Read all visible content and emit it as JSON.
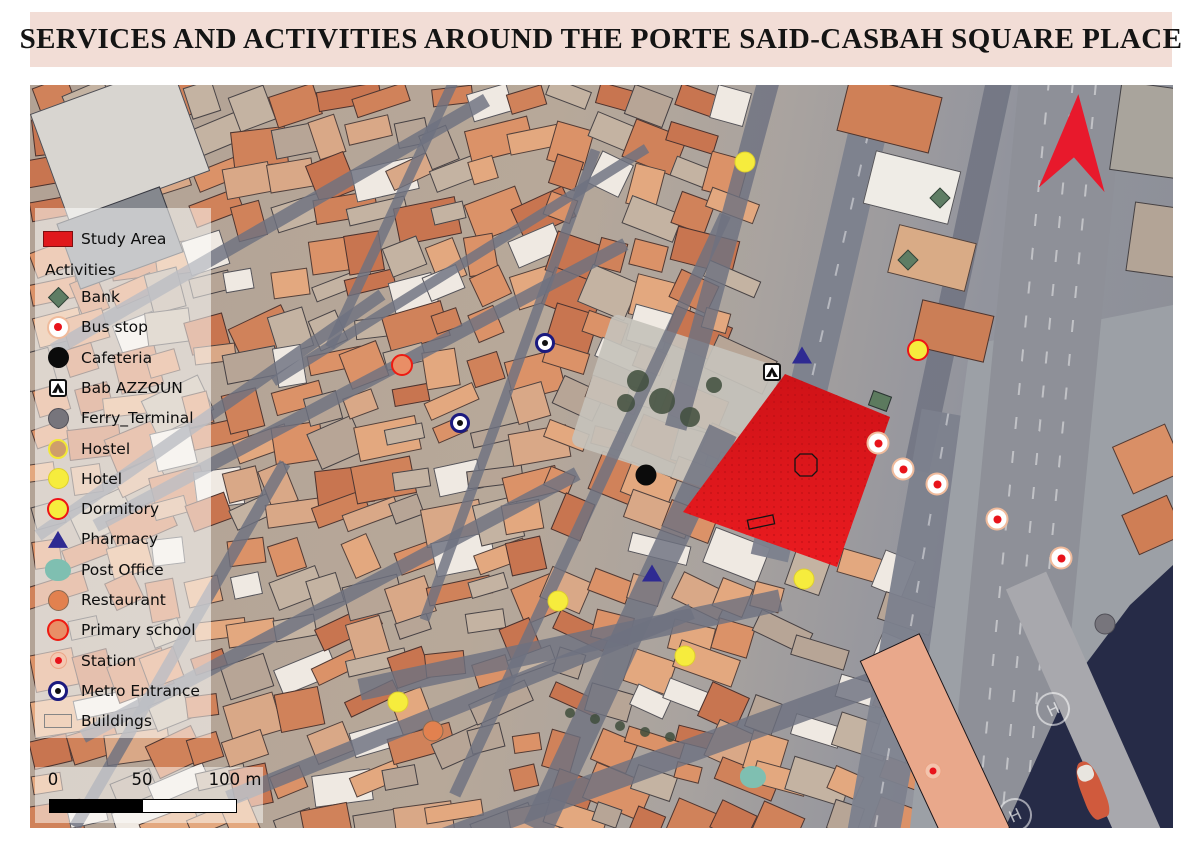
{
  "title": "SERVICES AND ACTIVITIES AROUND THE PORTE SAID-CASBAH SQUARE PLACE",
  "colors": {
    "banner_bg": "#f2ddd6",
    "study_area_red": "#e0181c",
    "bank_green": "#5e7d64",
    "hotel_yellow": "#f6ec3d",
    "dormitory_ring_red": "#ee1316",
    "pharmacy_navy": "#2e2a92",
    "post_office_teal": "#7fbfb1",
    "restaurant_orange": "#e2814f",
    "primary_school_salmon": "#e98e66",
    "metro_ring_navy": "#1b1a7f",
    "bus_stop_ring": "#f0bb9c",
    "station_dot_red": "#e8131b",
    "ferry_terminal_gray": "#77757c",
    "hostel_tan": "#cf9e6b",
    "water_navy": "#262b47",
    "north_arrow_red": "#e8192c"
  },
  "legend": {
    "study_area_label": "Study Area",
    "activities_header": "Activities",
    "items": [
      {
        "type": "bank",
        "label": "Bank"
      },
      {
        "type": "bus_stop",
        "label": "Bus stop"
      },
      {
        "type": "cafeteria",
        "label": "Cafeteria"
      },
      {
        "type": "bab_azzoun",
        "label": "Bab AZZOUN"
      },
      {
        "type": "ferry_terminal",
        "label": "Ferry_Terminal"
      },
      {
        "type": "hostel",
        "label": "Hostel"
      },
      {
        "type": "hotel",
        "label": "Hotel"
      },
      {
        "type": "dormitory",
        "label": "Dormitory"
      },
      {
        "type": "pharmacy",
        "label": "Pharmacy"
      },
      {
        "type": "post_office",
        "label": "Post Office"
      },
      {
        "type": "restaurant",
        "label": "Restaurant"
      },
      {
        "type": "primary_school",
        "label": "Primary school"
      },
      {
        "type": "station",
        "label": "Station"
      },
      {
        "type": "metro",
        "label": "Metro Entrance"
      },
      {
        "type": "buildings",
        "label": "Buildings"
      }
    ]
  },
  "scale_bar": {
    "tick_labels": [
      "0",
      "50",
      "100 m"
    ]
  },
  "map": {
    "helipad_label": "H",
    "study_area": {
      "polygon": [
        [
          755,
          289
        ],
        [
          860,
          332
        ],
        [
          807,
          482
        ],
        [
          653,
          427
        ]
      ],
      "octagon": [
        [
          770,
          369
        ],
        [
          782,
          369
        ],
        [
          787,
          374
        ],
        [
          787,
          386
        ],
        [
          782,
          391
        ],
        [
          770,
          391
        ],
        [
          765,
          386
        ],
        [
          765,
          374
        ]
      ],
      "inner_rect": [
        [
          717.4,
          435.3
        ],
        [
          742.8,
          429.9
        ],
        [
          744.6,
          438.7
        ],
        [
          719.2,
          444.1
        ]
      ]
    },
    "markers": [
      {
        "type": "hotel",
        "x": 715,
        "y": 77
      },
      {
        "type": "bank",
        "x": 910,
        "y": 113
      },
      {
        "type": "bank",
        "x": 878,
        "y": 175
      },
      {
        "type": "dormitory",
        "x": 888,
        "y": 265
      },
      {
        "type": "primary_school",
        "x": 372,
        "y": 280
      },
      {
        "type": "metro",
        "x": 515,
        "y": 258
      },
      {
        "type": "metro",
        "x": 430,
        "y": 338
      },
      {
        "type": "pharmacy",
        "x": 772,
        "y": 270
      },
      {
        "type": "bab_azzoun",
        "x": 742,
        "y": 287
      },
      {
        "type": "cafeteria",
        "x": 616,
        "y": 390
      },
      {
        "type": "bus_stop",
        "x": 848,
        "y": 358
      },
      {
        "type": "bus_stop",
        "x": 873,
        "y": 384
      },
      {
        "type": "bus_stop",
        "x": 907,
        "y": 399
      },
      {
        "type": "bus_stop",
        "x": 967,
        "y": 434
      },
      {
        "type": "bus_stop",
        "x": 1031,
        "y": 473
      },
      {
        "type": "hotel",
        "x": 774,
        "y": 494
      },
      {
        "type": "pharmacy",
        "x": 622,
        "y": 488
      },
      {
        "type": "hotel",
        "x": 528,
        "y": 516
      },
      {
        "type": "hotel",
        "x": 655,
        "y": 571
      },
      {
        "type": "hotel",
        "x": 368,
        "y": 617
      },
      {
        "type": "restaurant",
        "x": 403,
        "y": 646
      },
      {
        "type": "post_office",
        "x": 723,
        "y": 692
      },
      {
        "type": "ferry_terminal",
        "x": 1075,
        "y": 539
      },
      {
        "type": "station",
        "x": 903,
        "y": 686
      }
    ]
  }
}
